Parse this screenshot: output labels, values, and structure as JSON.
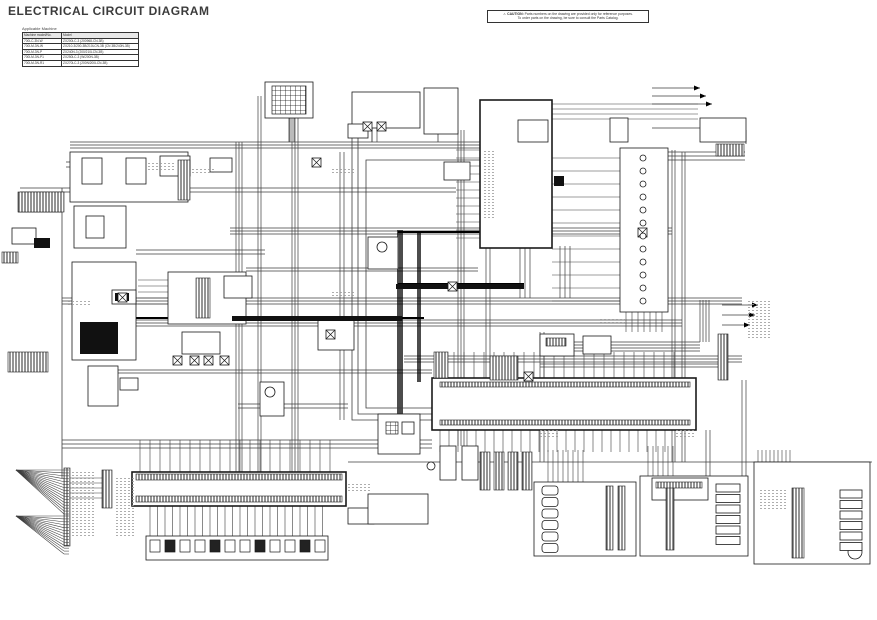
{
  "header": {
    "title": "ELECTRICAL CIRCUIT DIAGRAM"
  },
  "caution": {
    "icon": "⚠",
    "label": "CAUTION:",
    "line1": "Parts numbers on the drawing are provided only for reference purposes.",
    "line2": "To order parts on the drawing, be sure to consult the Parts Catalog."
  },
  "app_table": {
    "caption": "Applicable Machine",
    "headers": [
      "Machine model/No.",
      "Model"
    ],
    "rows": [
      [
        "700LC-3N-W",
        "ZX200LC-3 (200968-CN-3B)"
      ],
      [
        "700LM-3N-W",
        "ZX210-3/200-3B/210LCN-3B (CN 3B/240N-3B)"
      ],
      [
        "700LM-3N-P",
        "ZX240N-3 (200/210LCN-3B)"
      ],
      [
        "700LM-3N-P1",
        "ZX250LC-3 (W/200N-3B)"
      ],
      [
        "700LM-3N-R1",
        "ZX270LC-3 (200N/200LCN-3B)"
      ]
    ]
  },
  "schematic": {
    "colors": {
      "wire": "#3d3d3d",
      "trunk": "#000000",
      "block": "#1a1a1a",
      "noise": "#9a9a9a"
    },
    "hbundles": [
      [
        70,
        480,
        142,
        3,
        3
      ],
      [
        20,
        456,
        188,
        2,
        4
      ],
      [
        230,
        672,
        228,
        3,
        3
      ],
      [
        62,
        742,
        298,
        3,
        3
      ],
      [
        136,
        682,
        320,
        3,
        3
      ],
      [
        96,
        432,
        370,
        2,
        3
      ],
      [
        348,
        872,
        462,
        1,
        0
      ],
      [
        652,
        745,
        152,
        3,
        4
      ],
      [
        136,
        265,
        250,
        2,
        4
      ],
      [
        246,
        478,
        268,
        2,
        3
      ],
      [
        540,
        700,
        342,
        4,
        3
      ],
      [
        404,
        742,
        356,
        3,
        3
      ],
      [
        62,
        432,
        440,
        3,
        4
      ],
      [
        540,
        718,
        364,
        2,
        3
      ],
      [
        66,
        188,
        162,
        2,
        5
      ],
      [
        238,
        348,
        404,
        2,
        4
      ]
    ],
    "vbundles": [
      [
        142,
        472,
        236,
        3,
        3,
        0
      ],
      [
        96,
        472,
        258,
        2,
        3,
        0
      ],
      [
        118,
        472,
        292,
        3,
        3,
        0
      ],
      [
        152,
        420,
        340,
        2,
        4,
        0
      ],
      [
        230,
        428,
        398,
        3,
        2,
        1.4
      ],
      [
        232,
        382,
        418,
        2,
        2,
        1.4
      ],
      [
        130,
        446,
        458,
        3,
        3,
        0
      ],
      [
        150,
        462,
        672,
        2,
        3,
        0
      ],
      [
        152,
        462,
        682,
        2,
        3,
        0
      ],
      [
        246,
        378,
        486,
        2,
        4,
        0
      ],
      [
        300,
        342,
        700,
        4,
        3,
        0
      ],
      [
        380,
        476,
        742,
        2,
        4,
        0
      ],
      [
        246,
        298,
        520,
        3,
        5,
        0
      ],
      [
        246,
        298,
        560,
        3,
        5,
        0
      ],
      [
        332,
        462,
        540,
        2,
        4,
        0
      ],
      [
        430,
        476,
        706,
        2,
        4,
        0
      ],
      [
        88,
        142,
        290,
        2,
        4,
        0
      ],
      [
        118,
        142,
        372,
        2,
        5,
        0
      ]
    ],
    "combs": [
      {
        "o": "h",
        "a": 552,
        "b": 640,
        "p0": 158,
        "dp": 13,
        "n": 12
      },
      {
        "o": "h",
        "a": 456,
        "b": 480,
        "p0": 150,
        "dp": 8,
        "n": 12
      },
      {
        "o": "v",
        "a": 352,
        "b": 380,
        "p0": 444,
        "dp": 10,
        "n": 24
      },
      {
        "o": "v",
        "a": 430,
        "b": 452,
        "p0": 440,
        "dp": 9,
        "n": 26
      },
      {
        "o": "v",
        "a": 440,
        "b": 472,
        "p0": 140,
        "dp": 10,
        "n": 20
      },
      {
        "o": "v",
        "a": 505,
        "b": 538,
        "p0": 150,
        "dp": 7.5,
        "n": 24
      },
      {
        "o": "h",
        "a": 674,
        "b": 716,
        "p0": 488,
        "dp": 10.5,
        "n": 6
      },
      {
        "o": "h",
        "a": 804,
        "b": 840,
        "p0": 494,
        "dp": 10.5,
        "n": 6
      },
      {
        "o": "h",
        "a": 558,
        "b": 606,
        "p0": 492,
        "dp": 11.5,
        "n": 6
      },
      {
        "o": "v",
        "a": 450,
        "b": 486,
        "p0": 548,
        "dp": 5,
        "n": 8
      },
      {
        "o": "v",
        "a": 446,
        "b": 478,
        "p0": 648,
        "dp": 5,
        "n": 6
      },
      {
        "o": "v",
        "a": 450,
        "b": 488,
        "p0": 758,
        "dp": 4,
        "n": 9
      },
      {
        "o": "h",
        "a": 552,
        "b": 698,
        "p0": 104,
        "dp": 5,
        "n": 4
      },
      {
        "o": "h",
        "a": 68,
        "b": 102,
        "p0": 478,
        "dp": 5,
        "n": 5
      },
      {
        "o": "v",
        "a": 312,
        "b": 332,
        "p0": 626,
        "dp": 6,
        "n": 7
      },
      {
        "o": "h",
        "a": 138,
        "b": 168,
        "p0": 280,
        "dp": 6,
        "n": 5
      }
    ],
    "wires": [
      {
        "p": [
          [
            62,
            188
          ],
          [
            62,
            478
          ]
        ],
        "w": 0.8
      },
      {
        "p": [
          [
            289,
            118
          ],
          [
            289,
            142
          ]
        ],
        "w": 0.8
      },
      {
        "p": [
          [
            372,
            128
          ],
          [
            372,
            142
          ]
        ],
        "w": 0.8
      },
      {
        "p": [
          [
            438,
            134
          ],
          [
            438,
            142
          ]
        ],
        "w": 0.8
      },
      {
        "p": [
          [
            652,
            128
          ],
          [
            700,
            128
          ]
        ],
        "w": 0.8
      },
      {
        "p": [
          [
            746,
            130
          ],
          [
            746,
            144
          ]
        ],
        "w": 0.8
      },
      {
        "p": [
          [
            352,
            128
          ],
          [
            352,
            420
          ],
          [
            432,
            420
          ]
        ],
        "w": 0.8
      },
      {
        "p": [
          [
            358,
            134
          ],
          [
            358,
            414
          ],
          [
            432,
            414
          ]
        ],
        "w": 0.8
      },
      {
        "p": [
          [
            480,
            160
          ],
          [
            366,
            160
          ],
          [
            366,
            408
          ],
          [
            432,
            408
          ]
        ],
        "w": 0.8
      },
      {
        "p": [
          [
            136,
            318
          ],
          [
            424,
            318
          ]
        ],
        "w": 2
      },
      {
        "p": [
          [
            398,
            232
          ],
          [
            524,
            232
          ]
        ],
        "w": 2
      },
      {
        "p": [
          [
            652,
            88
          ],
          [
            700,
            88
          ]
        ],
        "w": 0.7
      },
      {
        "p": [
          [
            652,
            96
          ],
          [
            706,
            96
          ]
        ],
        "w": 0.7
      },
      {
        "p": [
          [
            652,
            104
          ],
          [
            712,
            104
          ]
        ],
        "w": 0.7
      },
      {
        "p": [
          [
            722,
            305
          ],
          [
            758,
            305
          ]
        ],
        "w": 0.7
      },
      {
        "p": [
          [
            722,
            315
          ],
          [
            755,
            315
          ]
        ],
        "w": 0.7
      },
      {
        "p": [
          [
            722,
            325
          ],
          [
            750,
            325
          ]
        ],
        "w": 0.7
      },
      {
        "p": [
          [
            18,
            212
          ],
          [
            62,
            212
          ]
        ],
        "w": 0.8
      },
      {
        "p": [
          [
            398,
            284
          ],
          [
            524,
            284
          ]
        ],
        "w": 2
      }
    ],
    "blocks": [
      [
        70,
        152,
        118,
        50,
        "box"
      ],
      [
        82,
        158,
        20,
        26,
        "box"
      ],
      [
        126,
        158,
        20,
        26,
        "box"
      ],
      [
        74,
        206,
        52,
        42,
        "box"
      ],
      [
        86,
        216,
        18,
        22,
        "box"
      ],
      [
        72,
        262,
        64,
        98,
        "box"
      ],
      [
        12,
        228,
        24,
        16,
        "box"
      ],
      [
        160,
        156,
        30,
        20,
        "box"
      ],
      [
        210,
        158,
        22,
        14,
        "box"
      ],
      [
        265,
        82,
        48,
        36,
        "box"
      ],
      [
        352,
        92,
        68,
        36,
        "box"
      ],
      [
        424,
        88,
        34,
        46,
        "box"
      ],
      [
        348,
        124,
        20,
        14,
        "box"
      ],
      [
        480,
        100,
        72,
        148,
        "bold"
      ],
      [
        518,
        120,
        30,
        22,
        "box"
      ],
      [
        610,
        118,
        18,
        24,
        "box"
      ],
      [
        700,
        118,
        46,
        24,
        "box"
      ],
      [
        620,
        148,
        48,
        164,
        "box"
      ],
      [
        444,
        162,
        26,
        18,
        "box"
      ],
      [
        168,
        272,
        78,
        52,
        "box"
      ],
      [
        224,
        276,
        28,
        22,
        "box"
      ],
      [
        112,
        290,
        24,
        14,
        "box"
      ],
      [
        88,
        366,
        30,
        40,
        "box"
      ],
      [
        120,
        378,
        18,
        12,
        "box"
      ],
      [
        182,
        332,
        38,
        22,
        "box"
      ],
      [
        318,
        320,
        36,
        30,
        "box"
      ],
      [
        368,
        237,
        30,
        32,
        "box"
      ],
      [
        260,
        382,
        24,
        34,
        "box"
      ],
      [
        540,
        334,
        34,
        22,
        "box"
      ],
      [
        583,
        336,
        28,
        18,
        "box"
      ],
      [
        432,
        378,
        264,
        52,
        "bold"
      ],
      [
        378,
        414,
        42,
        40,
        "box"
      ],
      [
        402,
        422,
        12,
        12,
        "box"
      ],
      [
        132,
        472,
        214,
        34,
        "bold"
      ],
      [
        146,
        536,
        182,
        24,
        "box"
      ],
      [
        348,
        508,
        26,
        16,
        "box"
      ],
      [
        368,
        494,
        60,
        30,
        "box"
      ],
      [
        440,
        446,
        16,
        34,
        "box"
      ],
      [
        462,
        446,
        16,
        34,
        "box"
      ],
      [
        534,
        482,
        102,
        74,
        "box"
      ],
      [
        640,
        476,
        108,
        80,
        "box"
      ],
      [
        652,
        478,
        56,
        22,
        "box"
      ],
      [
        754,
        462,
        116,
        102,
        "box"
      ]
    ],
    "pins": [
      [
        18,
        192,
        46,
        20
      ],
      [
        2,
        252,
        16,
        11
      ],
      [
        178,
        160,
        12,
        40
      ],
      [
        8,
        352,
        40,
        20
      ],
      [
        196,
        278,
        14,
        40
      ],
      [
        136,
        474,
        206,
        6
      ],
      [
        136,
        496,
        206,
        6
      ],
      [
        64,
        468,
        6,
        78
      ],
      [
        102,
        470,
        10,
        38
      ],
      [
        434,
        352,
        14,
        26
      ],
      [
        490,
        356,
        28,
        24
      ],
      [
        718,
        334,
        10,
        46
      ],
      [
        480,
        452,
        10,
        38
      ],
      [
        494,
        452,
        10,
        38
      ],
      [
        508,
        452,
        10,
        38
      ],
      [
        522,
        452,
        10,
        38
      ],
      [
        606,
        486,
        7,
        64
      ],
      [
        618,
        486,
        7,
        64
      ],
      [
        666,
        484,
        8,
        66
      ],
      [
        792,
        488,
        12,
        70
      ],
      [
        440,
        382,
        250,
        5
      ],
      [
        440,
        420,
        250,
        5
      ],
      [
        656,
        482,
        46,
        6
      ],
      [
        546,
        338,
        20,
        8
      ],
      [
        716,
        144,
        28,
        12
      ]
    ],
    "grids": [
      [
        272,
        86,
        34,
        28
      ],
      [
        386,
        422,
        12,
        12
      ]
    ],
    "dark": [
      [
        80,
        322,
        38,
        32
      ],
      [
        115,
        293,
        14,
        8
      ],
      [
        34,
        238,
        16,
        10
      ],
      [
        554,
        176,
        10,
        10
      ],
      [
        232,
        316,
        170,
        5
      ],
      [
        396,
        284,
        128,
        5
      ]
    ],
    "relays": [
      [
        173,
        356
      ],
      [
        190,
        356
      ],
      [
        204,
        356
      ],
      [
        220,
        356
      ],
      [
        312,
        158
      ],
      [
        363,
        122
      ],
      [
        377,
        122
      ],
      [
        524,
        372
      ],
      [
        448,
        282
      ],
      [
        638,
        228
      ],
      [
        326,
        330
      ],
      [
        118,
        293
      ]
    ],
    "circles": [
      [
        643,
        158,
        3
      ],
      [
        643,
        171,
        3
      ],
      [
        643,
        184,
        3
      ],
      [
        643,
        197,
        3
      ],
      [
        643,
        210,
        3
      ],
      [
        643,
        223,
        3
      ],
      [
        643,
        236,
        3
      ],
      [
        643,
        249,
        3
      ],
      [
        643,
        262,
        3
      ],
      [
        643,
        275,
        3
      ],
      [
        643,
        288,
        3
      ],
      [
        643,
        301,
        3
      ],
      [
        382,
        247,
        5
      ],
      [
        270,
        392,
        5
      ],
      [
        431,
        466,
        4
      ],
      [
        855,
        552,
        7
      ]
    ],
    "rowboxes": [
      {
        "x": 542,
        "y": 486,
        "n": 6,
        "dy": 11.5,
        "w": 16,
        "h": 9,
        "rx": 3
      },
      {
        "x": 716,
        "y": 484,
        "n": 6,
        "dy": 10.5,
        "w": 24,
        "h": 8,
        "rx": 0
      },
      {
        "x": 840,
        "y": 490,
        "n": 6,
        "dy": 10.5,
        "w": 22,
        "h": 8,
        "rx": 0
      }
    ],
    "minirows": [
      {
        "x0": 150,
        "y": 540,
        "n": 12,
        "dx": 15,
        "w": 10,
        "h": 12
      }
    ],
    "fans": [
      {
        "x": 16,
        "y": 470,
        "w": 48,
        "h": 44,
        "n": 16
      },
      {
        "x": 16,
        "y": 516,
        "w": 48,
        "h": 38,
        "n": 14
      }
    ],
    "marks": [
      [
        700,
        88
      ],
      [
        706,
        96
      ],
      [
        712,
        104
      ],
      [
        758,
        305
      ],
      [
        755,
        315
      ],
      [
        750,
        325
      ]
    ],
    "noise": [
      [
        146,
        162,
        30,
        8
      ],
      [
        190,
        168,
        24,
        6
      ],
      [
        330,
        168,
        26,
        6
      ],
      [
        482,
        150,
        14,
        70
      ],
      [
        600,
        318,
        26,
        6
      ],
      [
        330,
        290,
        24,
        6
      ],
      [
        68,
        300,
        22,
        6
      ],
      [
        70,
        472,
        26,
        66
      ],
      [
        114,
        476,
        22,
        60
      ],
      [
        348,
        482,
        24,
        10
      ],
      [
        748,
        300,
        22,
        40
      ],
      [
        760,
        488,
        26,
        22
      ],
      [
        676,
        430,
        20,
        8
      ],
      [
        540,
        430,
        20,
        8
      ]
    ]
  }
}
